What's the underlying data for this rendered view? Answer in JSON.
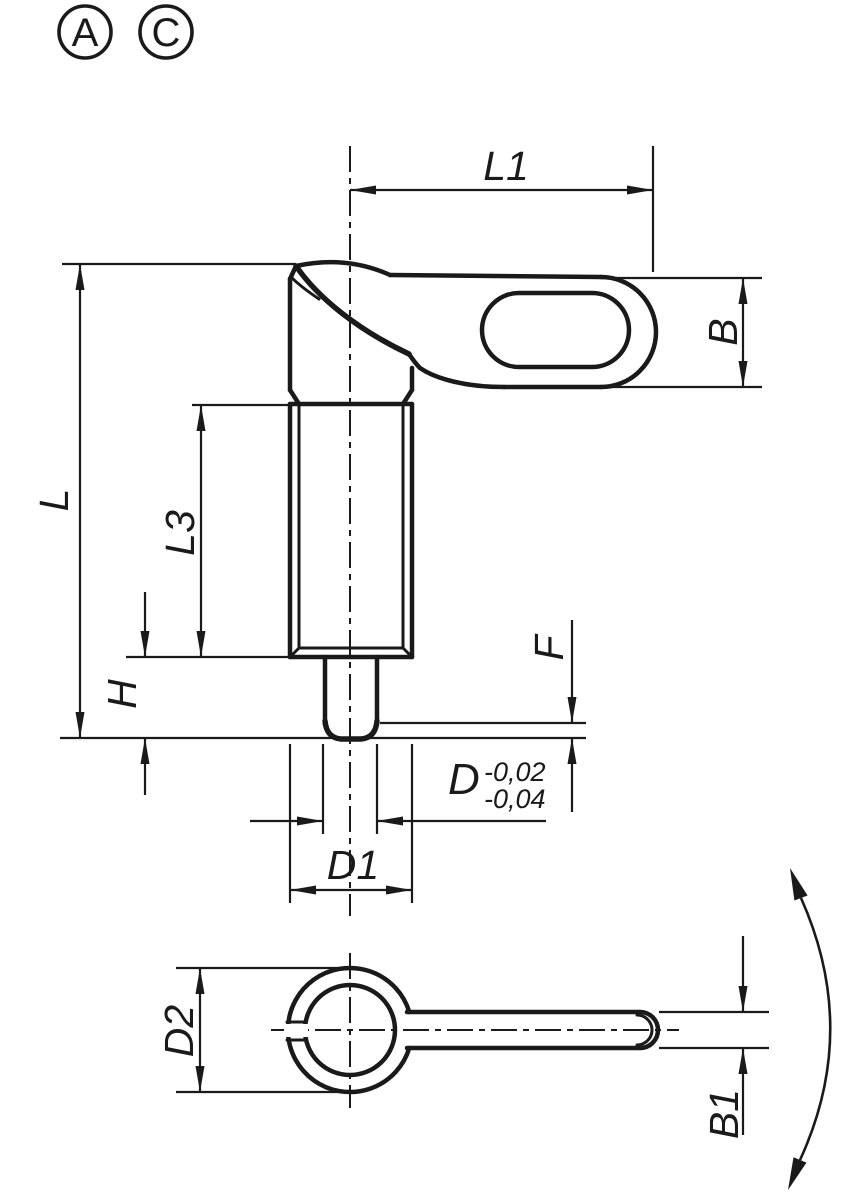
{
  "drawing": {
    "type": "technical-drawing-indexing-plunger",
    "colors": {
      "line": "#1a1a1a",
      "background": "#ffffff"
    },
    "view_markers": {
      "a": "A",
      "c": "C"
    },
    "dimensions": {
      "l1": "L1",
      "b": "B",
      "l": "L",
      "l3": "L3",
      "h": "H",
      "f": "F",
      "d": "D",
      "d_tol_upper": "-0,02",
      "d_tol_lower": "-0,04",
      "d1": "D1",
      "d2": "D2",
      "b1": "B1"
    }
  }
}
